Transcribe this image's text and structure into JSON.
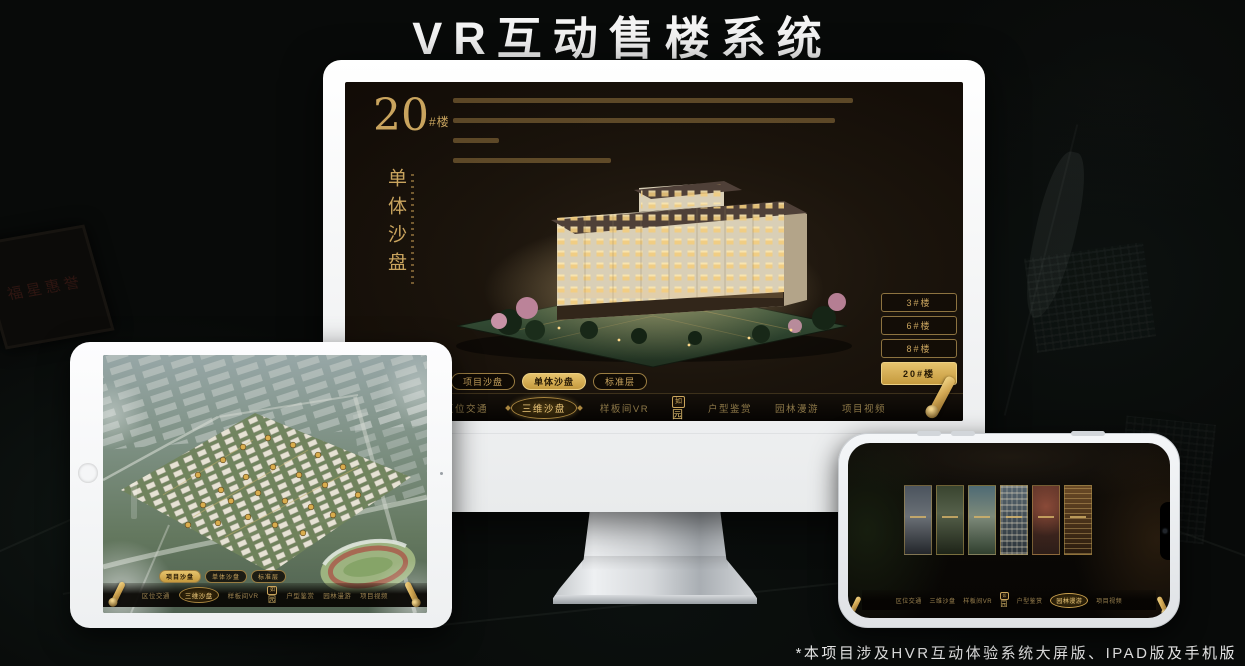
{
  "page": {
    "title": "VR互动售楼系统",
    "footnote": "*本项目涉及HVR互动体验系统大屏版、IPAD版及手机版"
  },
  "logo": {
    "seal": "如",
    "name": "园"
  },
  "background": {
    "plaque_text": "福星惠誉"
  },
  "desktop": {
    "hero_number": "20",
    "hero_suffix": "#楼",
    "hero_subtitle": "单体沙盘",
    "floor_buttons": [
      "3#楼",
      "6#楼",
      "8#楼",
      "20#楼"
    ],
    "active_floor": "20#楼",
    "sub_tabs": [
      "项目沙盘",
      "单体沙盘",
      "标准层"
    ],
    "active_sub_tab": "单体沙盘",
    "nav_items": [
      "区位交通",
      "三维沙盘",
      "样板间VR",
      "户型鉴赏",
      "园林漫游",
      "项目视频"
    ],
    "active_nav": "三维沙盘"
  },
  "tablet": {
    "sub_tabs": [
      "项目沙盘",
      "单体沙盘",
      "标准层"
    ],
    "active_sub_tab": "项目沙盘",
    "nav_items": [
      "区位交通",
      "三维沙盘",
      "样板间VR",
      "户型鉴赏",
      "园林漫游",
      "项目视频"
    ],
    "active_nav": "三维沙盘"
  },
  "phone": {
    "nav_items": [
      "区位交通",
      "三维沙盘",
      "样板间VR",
      "户型鉴赏",
      "园林漫游",
      "项目视频"
    ],
    "active_nav": "园林漫游"
  },
  "colors": {
    "gold": "#c9a45e",
    "gold_active": "#e6c36d",
    "screen_bg": "#1b140c"
  }
}
